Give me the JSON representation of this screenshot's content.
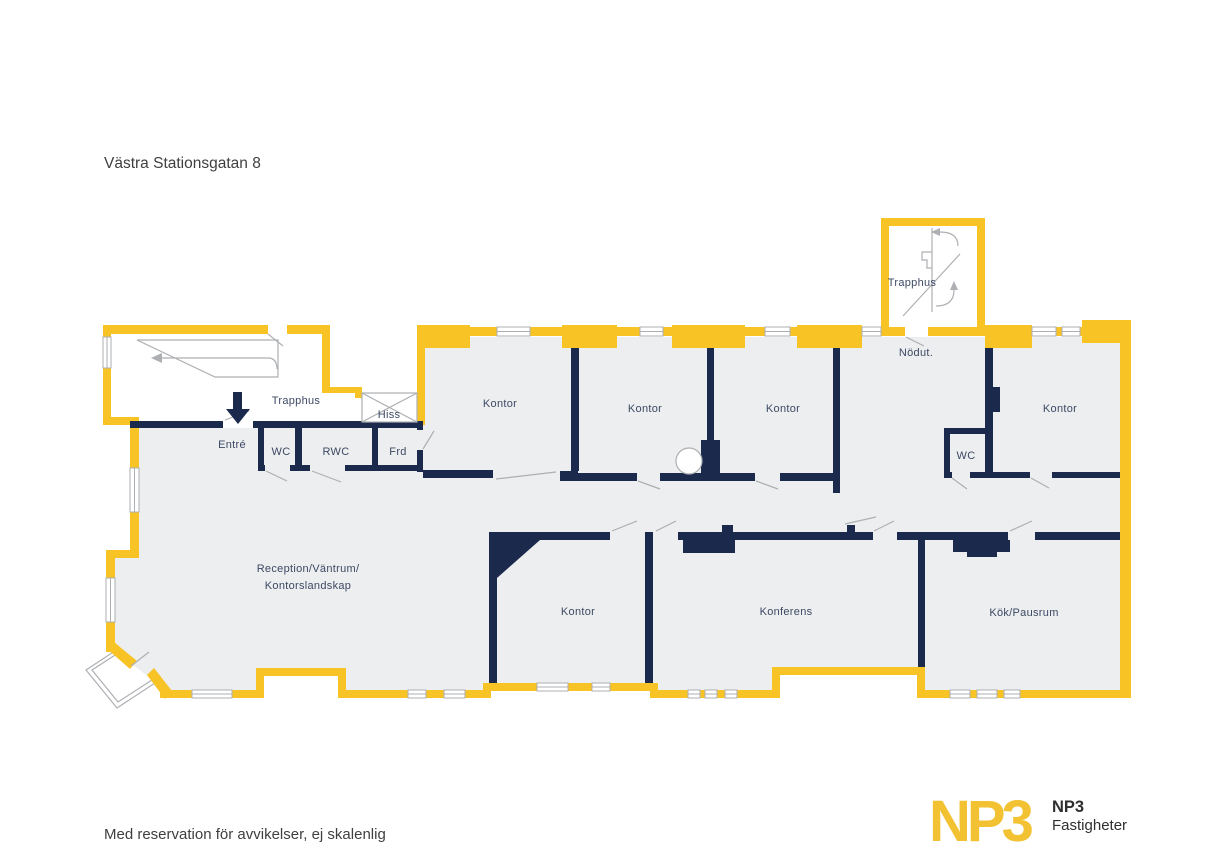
{
  "page": {
    "title": "Västra Stationsgatan 8",
    "disclaimer": "Med reservation för avvikelser, ej skalenlig"
  },
  "logo": {
    "wordmark": "NP3",
    "company": "NP3",
    "company_suffix": "Fastigheter"
  },
  "colors": {
    "wall-exterior": "#F8C324",
    "wall-interior": "#1B2A4C",
    "floor": "#EDEEEF",
    "line": "#ADAFB2",
    "label": "#3C4964",
    "text": "#3F3F3F",
    "logo-gold": "#F2C233"
  },
  "rooms": {
    "trapphus_left": "Trapphus",
    "trapphus_right": "Trapphus",
    "hiss": "Hiss",
    "entre": "Entré",
    "wc_left": "WC",
    "rwc": "RWC",
    "frd": "Frd",
    "nodut": "Nödut.",
    "wc_right": "WC",
    "kontor_1": "Kontor",
    "kontor_2": "Kontor",
    "kontor_3": "Kontor",
    "kontor_4": "Kontor",
    "kontor_5": "Kontor",
    "reception_line1": "Reception/Väntrum/",
    "reception_line2": "Kontorslandskap",
    "konferens": "Konferens",
    "kok_pausrum": "Kök/Pausrum"
  },
  "icons": {
    "entrance_arrow": "down-arrow",
    "stairs_left": "stair-run-arrow",
    "stairs_right": "stair-turn-arrows",
    "elevator": "crossed-box",
    "balcony": "rotated-square-bay"
  }
}
